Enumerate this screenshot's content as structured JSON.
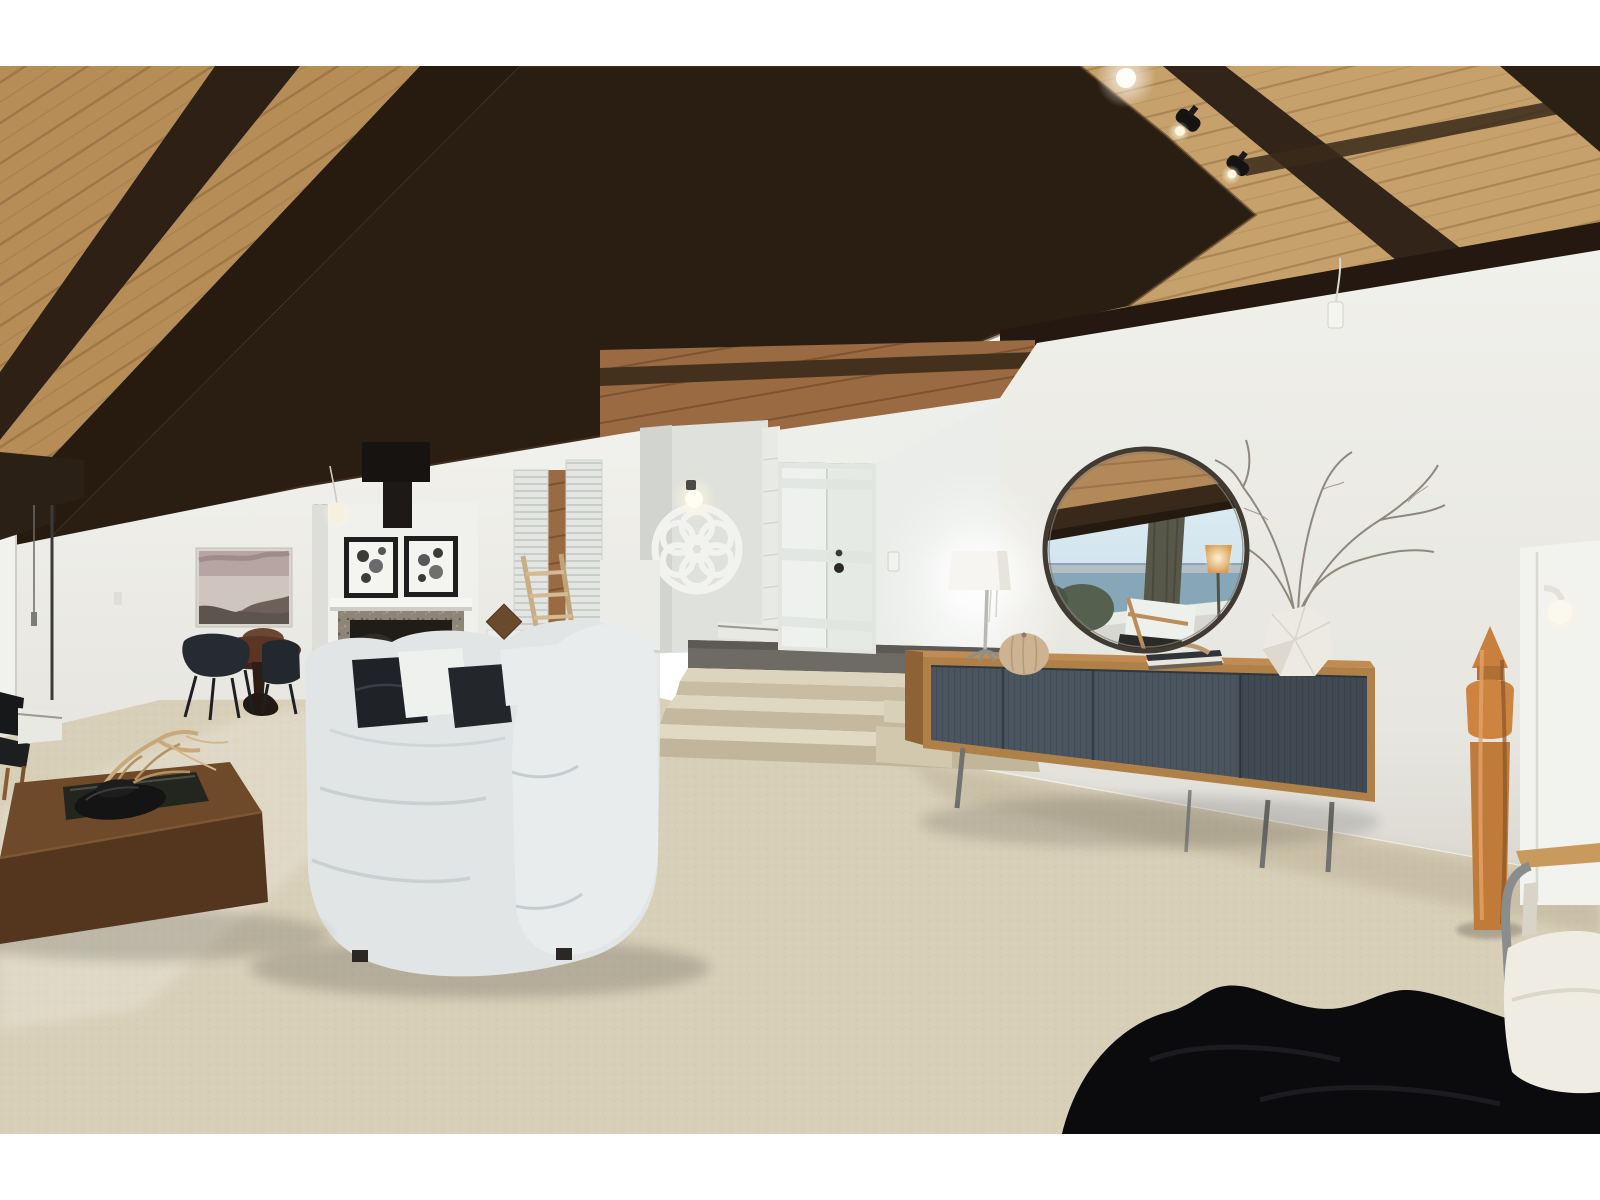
{
  "meta": {
    "kind": "real-estate interior photograph",
    "room": "mid-century living room with vaulted wood ceiling, raised entry landing, fireplace, dining nook and staged furniture",
    "photo_margins": "white band above and below the photograph"
  },
  "palette": {
    "margin": "#ffffff",
    "wall": "#ececе7",
    "wall_main": "#ecebe6",
    "wall_right": "#e9e8e2",
    "wall_shadow": "#d9d8d1",
    "ceiling_plank": "#b68c57",
    "ceiling_plank_right": "#c6a16c",
    "beam": "#2a1d12",
    "beam_edge": "#543b24",
    "cedar": "#9a6a42",
    "carpet": "#d8cfb8",
    "step": "#ddd4bd",
    "step_riser": "#c8bda2",
    "entry_floor": "#6e6a64",
    "door": "#eff1ee",
    "chase": "#f0f1ed",
    "granite": "#8d8577",
    "firebox": "#201c18",
    "frame_black": "#1e1e1e",
    "sofa": "#e2e5e6",
    "sofa_shade": "#c9cfd2",
    "pillow_black": "#1f2226",
    "pillow_white": "#eff1ef",
    "coffee_top": "#6e4a2b",
    "coffee_front": "#54351d",
    "glass_inset": "#23261f",
    "stone_black": "#141414",
    "branch_tan": "#c8a87c",
    "credenza_wood": "#b08049",
    "credenza_side": "#8f6236",
    "credenza_door": "#4a555f",
    "leg_metal": "#75777样4",
    "mirror_frame": "#413a32",
    "mirror_sky": "#d9e9f2",
    "mirror_water": "#87a7b8",
    "mirror_trunk": "#57584a",
    "sculpture_wood": "#c9803c",
    "fur_rug": "#0b0b0d",
    "chair_navy": "#262b32",
    "table_walnut": "#5c3424",
    "lamp_shade": "#f6f5f1",
    "vase_white": "#eceae3",
    "louver": "#e3e6e2",
    "seascape_sky": "#b6a5a3",
    "seascape_water": "#cfc5bf",
    "rock_dark": "#4f463f",
    "ladder_wood": "#c9ae85",
    "heater_white": "#e9e9e4",
    "chair_cream": "#efece3",
    "armrest_wood": "#c99a5e"
  },
  "scene": {
    "objects": [
      {
        "name": "vaulted-plank-ceiling",
        "desc": "tongue-and-groove cedar planks with dark stained exposed beams fanning toward the left"
      },
      {
        "name": "ceiling-spotlights",
        "desc": "two black track spot lights and one recessed glow near top right"
      },
      {
        "name": "pendant-bulb",
        "desc": "small teardrop pendant hanging from a beam on a chain"
      },
      {
        "name": "round-mirror",
        "desc": "large circular mirror reflecting an ocean view, tree trunk, deck chair and amber lamp"
      },
      {
        "name": "credenza",
        "desc": "teak sideboard with four slate-blue doors on thin metal legs"
      },
      {
        "name": "table-lamp",
        "desc": "white drum-shade lamp glowing against the right wall"
      },
      {
        "name": "faceted-vase-with-branches",
        "desc": "white geometric vase holding bare branches"
      },
      {
        "name": "ribbed-gourd-decor",
        "desc": "beige ribbed gourd object on the credenza"
      },
      {
        "name": "books-and-driftwood",
        "desc": "stacked books with driftwood under the mirror"
      },
      {
        "name": "sectional-sofa",
        "desc": "light grey cloud sofa with black and white pillows"
      },
      {
        "name": "fireplace",
        "desc": "white chase with granite surround, black flue and two botanical prints"
      },
      {
        "name": "decorative-ladder",
        "desc": "blonde wood ladder leaning beside the fireplace"
      },
      {
        "name": "entry-landing",
        "desc": "raised landing with grey carpet, three carpeted steps and white double front doors"
      },
      {
        "name": "rosette-window-ornament",
        "desc": "white flower-shaped rosette on the entry wall with a glowing sconce"
      },
      {
        "name": "dining-set",
        "desc": "dark oval table with navy shell chairs below a seascape print"
      },
      {
        "name": "seascape-art",
        "desc": "mauve-toned coastal photograph on the left wall"
      },
      {
        "name": "coffee-table",
        "desc": "low walnut block table with glass inset, black stone sculpture and driftwood branch"
      },
      {
        "name": "wood-totem-sculpture",
        "desc": "tall turned-wood sculpture on the right"
      },
      {
        "name": "lounge-chair",
        "desc": "grey tube-frame chair with cream cushion, bottom right corner"
      },
      {
        "name": "black-fur-rug",
        "desc": "black sheepskin style rug at the bottom edge"
      },
      {
        "name": "beige-carpet",
        "desc": "wall-to-wall speckled beige carpet"
      }
    ]
  }
}
